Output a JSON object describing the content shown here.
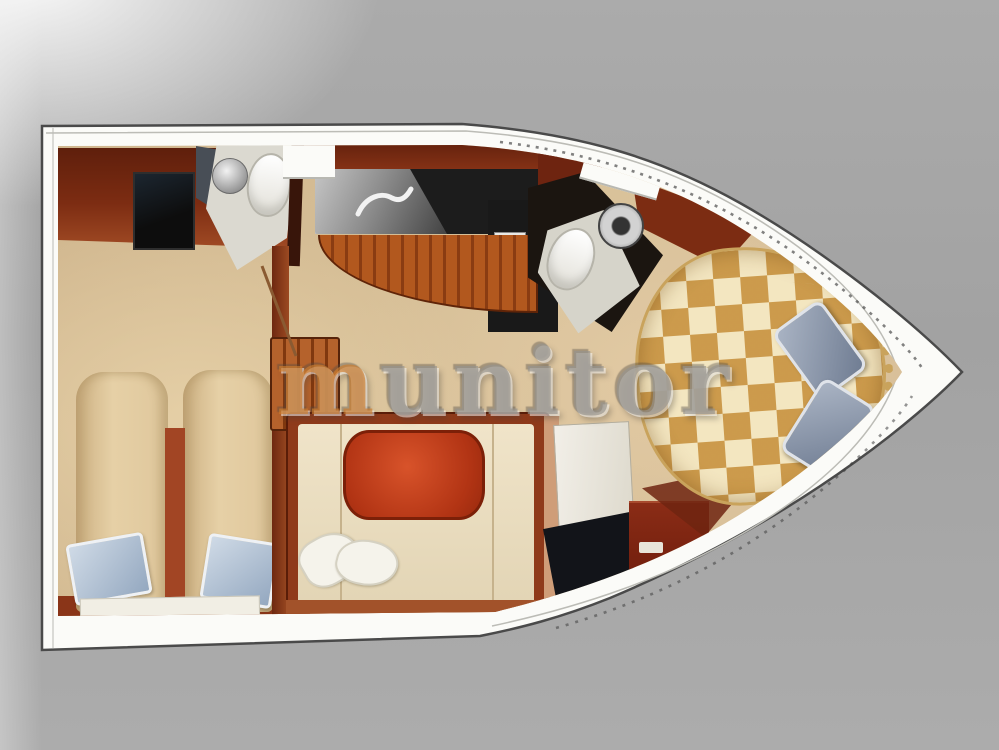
{
  "watermark": {
    "text": "munitor",
    "first_letter": "m",
    "rest_letters": "unitor",
    "first_letter_color": "#cd7d2d",
    "body_color": "#96938e"
  },
  "colors": {
    "background_gray": "#a2a2a2",
    "deck_white": "#fbfbf8",
    "hull_outline": "#4a4a4a",
    "carpet_tan": "#d7c098",
    "wood_red": "#7c2c12",
    "wood_orange": "#b2581e",
    "counter_black": "#1c1c1c",
    "sofa_cream": "#e2d4b4",
    "table_red": "#b23414",
    "bed_tan": "#e6d0a6",
    "pillow_blue": "#94a8c0",
    "shelf_white": "#f1eee4",
    "bow_pillow_gray": "#6f7c92",
    "checker_gold": "#c68f3a",
    "checker_cream": "#f8ecca",
    "trim_gold": "#c9a35c",
    "bath_floor": "#dbd9d0",
    "dark_wall": "#1b1510"
  },
  "floorplan": {
    "subject": "motor-yacht interior layout, top-down view",
    "orientation": "bow pointing right, stern at left",
    "rooms": [
      {
        "id": "aft-cabin",
        "label": "aft cabin with two single berths and TV cabinet"
      },
      {
        "id": "aft-head",
        "label": "aft head with toilet and round sink"
      },
      {
        "id": "galley",
        "label": "galley with black L-shaped counter, sink and curved wood bar front"
      },
      {
        "id": "salon",
        "label": "salon with U-shaped cream settee and red oval table"
      },
      {
        "id": "forward-head",
        "label": "forward head with toilet and round sink"
      },
      {
        "id": "bow-cabin",
        "label": "bow cabin with checkered V-berth and two gray pillows"
      }
    ],
    "furniture": [
      "tv-screen",
      "single-berth-left",
      "single-berth-right",
      "blue-pillows",
      "white-shelf",
      "toilet",
      "round-sink",
      "galley-counter",
      "galley-faucet",
      "companionway-steps",
      "settee",
      "salon-table",
      "white-throw-pillows",
      "wardrobe-door",
      "dresser-cabinet",
      "v-berth-checkered-bed",
      "gray-bow-pillows",
      "gold-bead-trim"
    ]
  }
}
